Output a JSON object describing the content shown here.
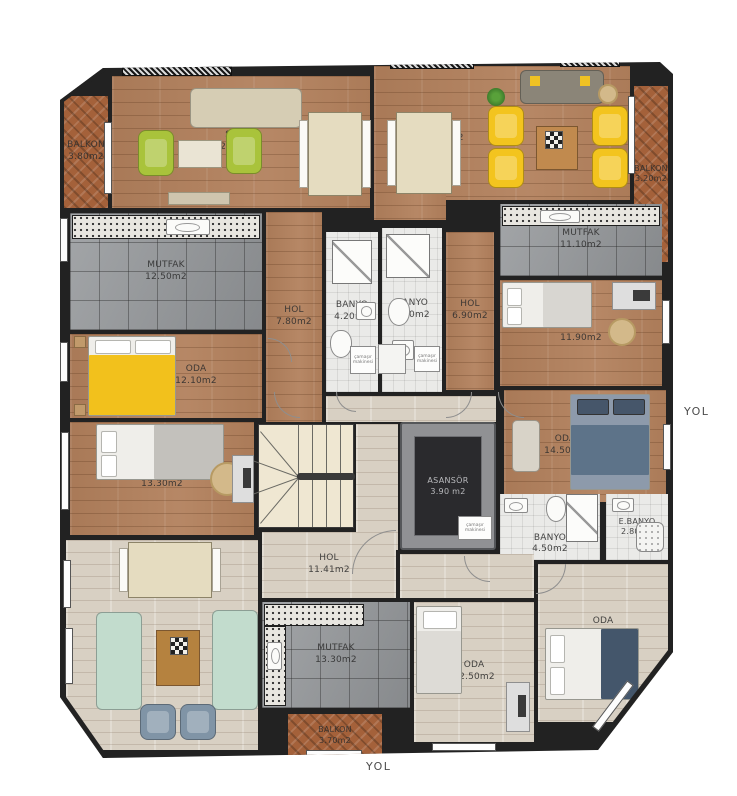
{
  "colors": {
    "wall": "#222222",
    "wood": "#b2805c",
    "wood_light": "#d8d0c3",
    "tile": "#96999c",
    "bath": "#eaeae8",
    "balcony": "#a4613a",
    "stairs": "#efe7d2",
    "elevator": "#2a2a2d",
    "accent_green": "#a9c33b",
    "accent_yellow": "#f3c41e",
    "sofa_mint": "#c2dccd",
    "armchair_blue": "#8094a6",
    "bed_blue": "#6e8094"
  },
  "yol": "YOL",
  "washer_label": "çamaşır makinesi",
  "rooms": {
    "balkon_tl": {
      "label": "BALKON",
      "area": "3.80m2"
    },
    "salon_tl": {
      "label": "SALON",
      "area": "26.20m2"
    },
    "mutfak_l": {
      "label": "MUTFAK",
      "area": "12.50m2"
    },
    "hol_l": {
      "label": "HOL",
      "area": "7.80m2"
    },
    "oda_l1": {
      "label": "ODA",
      "area": "12.10m2"
    },
    "oda_l2": {
      "label": "ODA",
      "area": "13.30m2"
    },
    "banyo1": {
      "label": "BANYO",
      "area": "4.20m2"
    },
    "banyo2": {
      "label": "BANYO",
      "area": "5.00m2"
    },
    "hol_c": {
      "label": "HOL",
      "area": "6.90m2"
    },
    "salon_tr": {
      "label": "SALON",
      "area": "24.40m2"
    },
    "balkon_tr": {
      "label": "BALKON",
      "area": "3.20m2"
    },
    "mutfak_r": {
      "label": "MUTFAK",
      "area": "11.10m2"
    },
    "oda_r1": {
      "label": "ODA",
      "area": "11.90m2"
    },
    "oda_r2": {
      "label": "ODA",
      "area": "14.50m2"
    },
    "asansor": {
      "label": "ASANSÖR",
      "area": "3.90 m2"
    },
    "banyo3": {
      "label": "BANYO",
      "area": "4.50m2"
    },
    "ebanyo": {
      "label": "E.BANYO",
      "area": "2.80m2"
    },
    "salon_b": {
      "label": "SALON",
      "area": "27.90m2"
    },
    "hol_b": {
      "label": "HOL",
      "area": "11.41m2"
    },
    "mutfak_b": {
      "label": "MUTFAK",
      "area": "13.30m2"
    },
    "oda_b1": {
      "label": "ODA",
      "area": "12.50m2"
    },
    "oda_b2": {
      "label": "ODA",
      "area": "13.90m2"
    },
    "balkon_b": {
      "label": "BALKON",
      "area": "3.70m2"
    }
  }
}
